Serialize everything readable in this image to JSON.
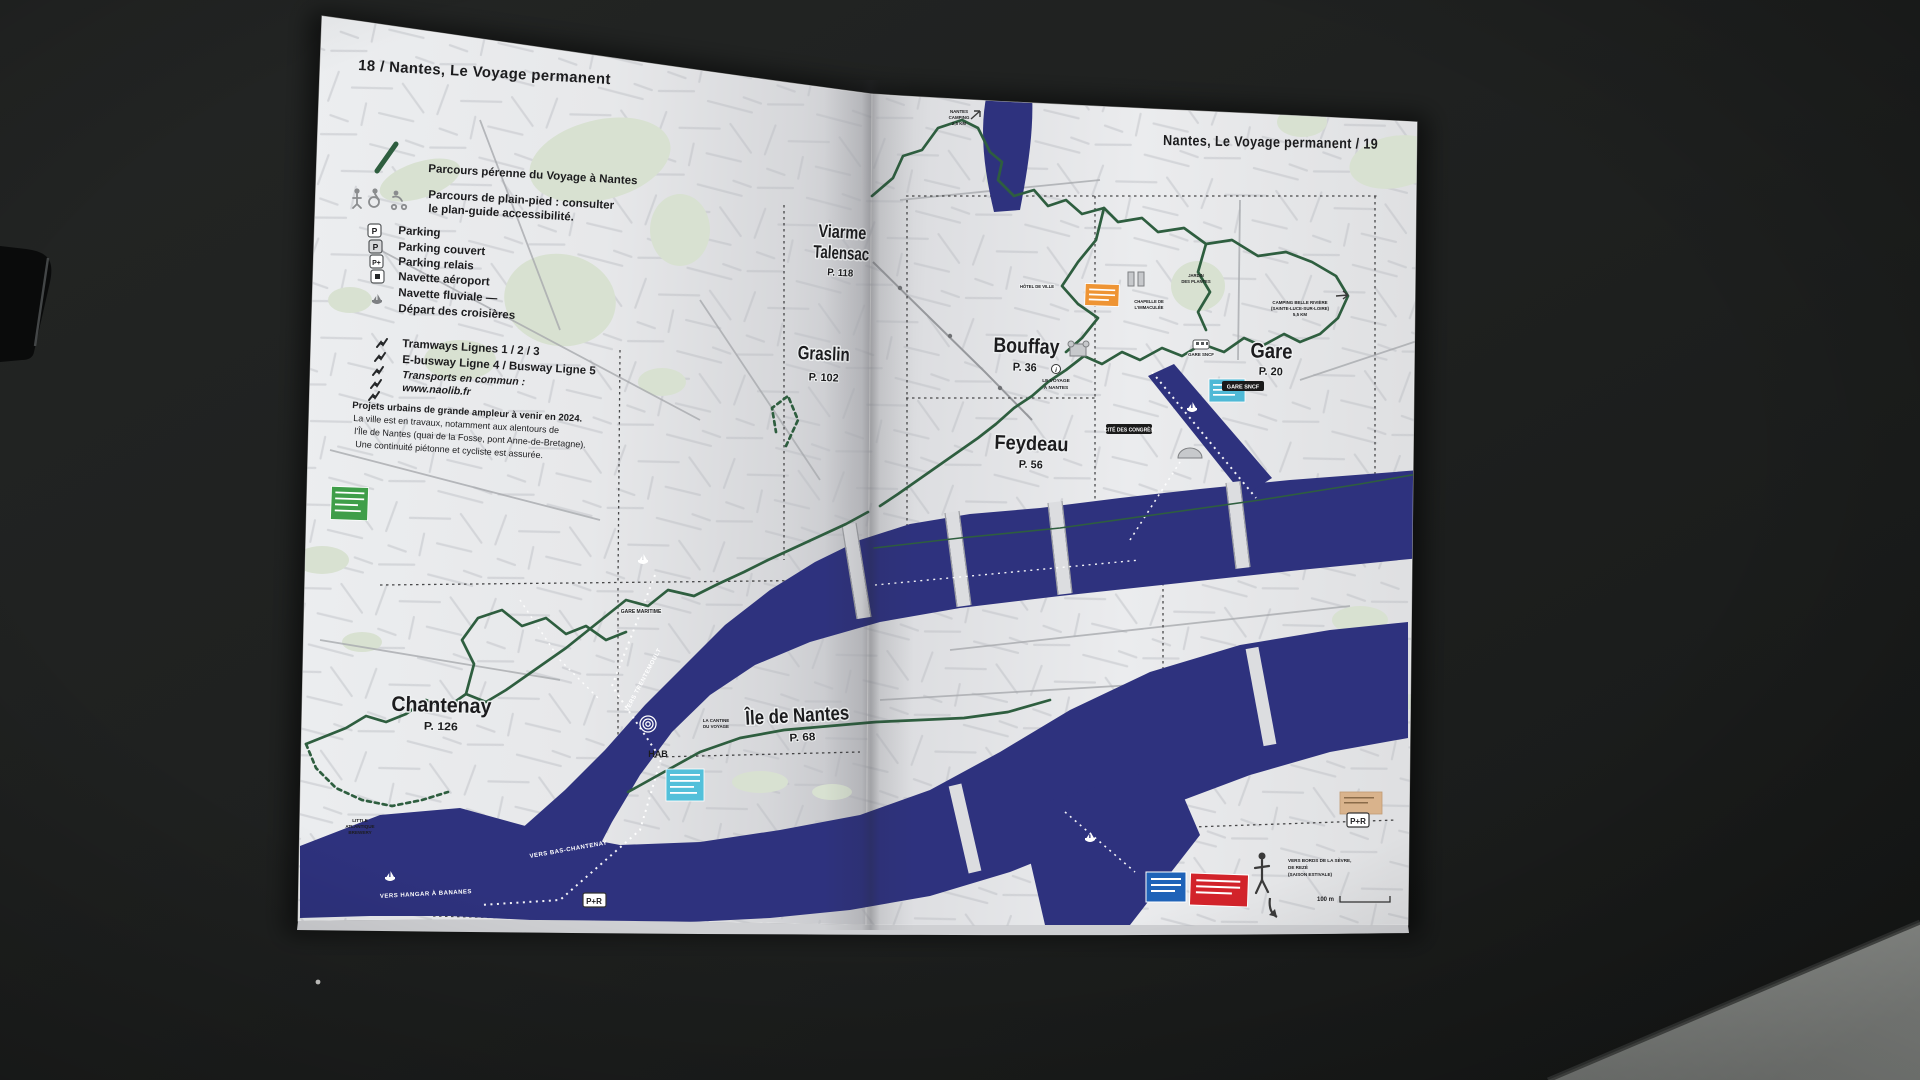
{
  "colors": {
    "river": "#2e327e",
    "route_green": "#2e5e3f",
    "park_green": "#d8e1d1",
    "page": "#e9eaec",
    "table_dark": "#1e201f",
    "floor_light": "#8f928f",
    "orange_badge": "#ee9434",
    "red_badge": "#d2232a",
    "blue_badge": "#1f63b8",
    "cyan_badge": "#4fb9d6",
    "green_badge": "#3f9e49",
    "busway4": "#9aa36e",
    "busway5": "#8f98a3"
  },
  "left_page": {
    "title": "18 / Nantes, Le Voyage permanent",
    "legend": {
      "route_label": "Parcours pérenne du Voyage à Nantes",
      "accessible_line1": "Parcours de plain-pied : consulter",
      "accessible_line2": "le plan-guide accessibilité.",
      "icon_p": "P",
      "icon_p_couvert": "P",
      "icon_p_relais": "P+",
      "items": [
        "Parking",
        "Parking couvert",
        "Parking relais",
        "Navette aéroport",
        "Navette fluviale —",
        "Départ des croisières"
      ],
      "tram_label": "Tramways Lignes 1 / 2 / 3",
      "busway_prefix": "E-busway Ligne ",
      "busway_line4": "4",
      "busway_separator": " / Busway Ligne ",
      "busway_line5": "5",
      "transit_label": "Transports en commun :",
      "transit_url": "www.naolib.fr",
      "notice_line1": "Projets urbains de grande ampleur à venir en 2024.",
      "notice_line2": "La ville est en travaux, notamment aux alentours de",
      "notice_line3": "l'Île de Nantes (quai de la Fosse, pont Anne-de-Bretagne).",
      "notice_line4": "Une continuité piétonne et cycliste est assurée."
    },
    "districts": [
      {
        "name": "Chantenay",
        "page_ref": "P. 126"
      },
      {
        "name": "Île de Nantes",
        "page_ref": "P. 68"
      }
    ],
    "labels": {
      "trentemoult": "TRENTEMOULT",
      "gare_maritime": "GARE MARITIME",
      "brewery1": "LITTLE",
      "brewery2": "ATLANTIQUE",
      "brewery3": "BREWERY",
      "hab": "HAB",
      "cantine1": "LA CANTINE",
      "cantine2": "DU VOYAGE",
      "vers_hangar": "VERS HANGAR À BANANES",
      "vers_bas_chantenay": "VERS BAS-CHANTENAY",
      "vers_trentemoult": "VERS TRENTEMOULT",
      "pr_box": "P+R"
    }
  },
  "right_page": {
    "title": "Nantes, Le Voyage permanent / 19",
    "districts": [
      {
        "name": "Viarme",
        "name_line2": "Talensac",
        "page_ref": "P. 118"
      },
      {
        "name": "Graslin",
        "page_ref": "P. 102"
      },
      {
        "name": "Bouffay",
        "page_ref": "P. 36"
      },
      {
        "name": "Feydeau",
        "page_ref": "P. 56"
      },
      {
        "name": "Gare",
        "page_ref": "P. 20"
      }
    ],
    "labels": {
      "camping_n1": "NANTES",
      "camping_n2": "CAMPING",
      "camping_n3": "2,5 KM",
      "camping_b1": "CAMPING BELLE RIVIÈRE",
      "camping_b2": "(SAINTE-LUCE-SUR-LOIRE)",
      "camping_b3": "5,5 KM",
      "gare_sncf": "GARE SNCF",
      "gare_sncf_pill": "GARE SNCF",
      "cite_congres": "CITÉ DES CONGRÈS",
      "voyage_i": "i",
      "voyage1": "LE VOYAGE",
      "voyage2": "À NANTES",
      "hotel_ville": "HÔTEL DE VILLE",
      "jardin1": "JARDIN",
      "jardin2": "DES PLANTES",
      "chapelle1": "CHAPELLE DE",
      "chapelle2": "L'IMMACULÉE",
      "sevre1": "VERS BORDS DE LA SÈVRE,",
      "sevre2": "DE REZÉ",
      "sevre3": "(SAISON ESTIVALE)",
      "scale": "100 m",
      "pr_box": "P+R"
    }
  }
}
